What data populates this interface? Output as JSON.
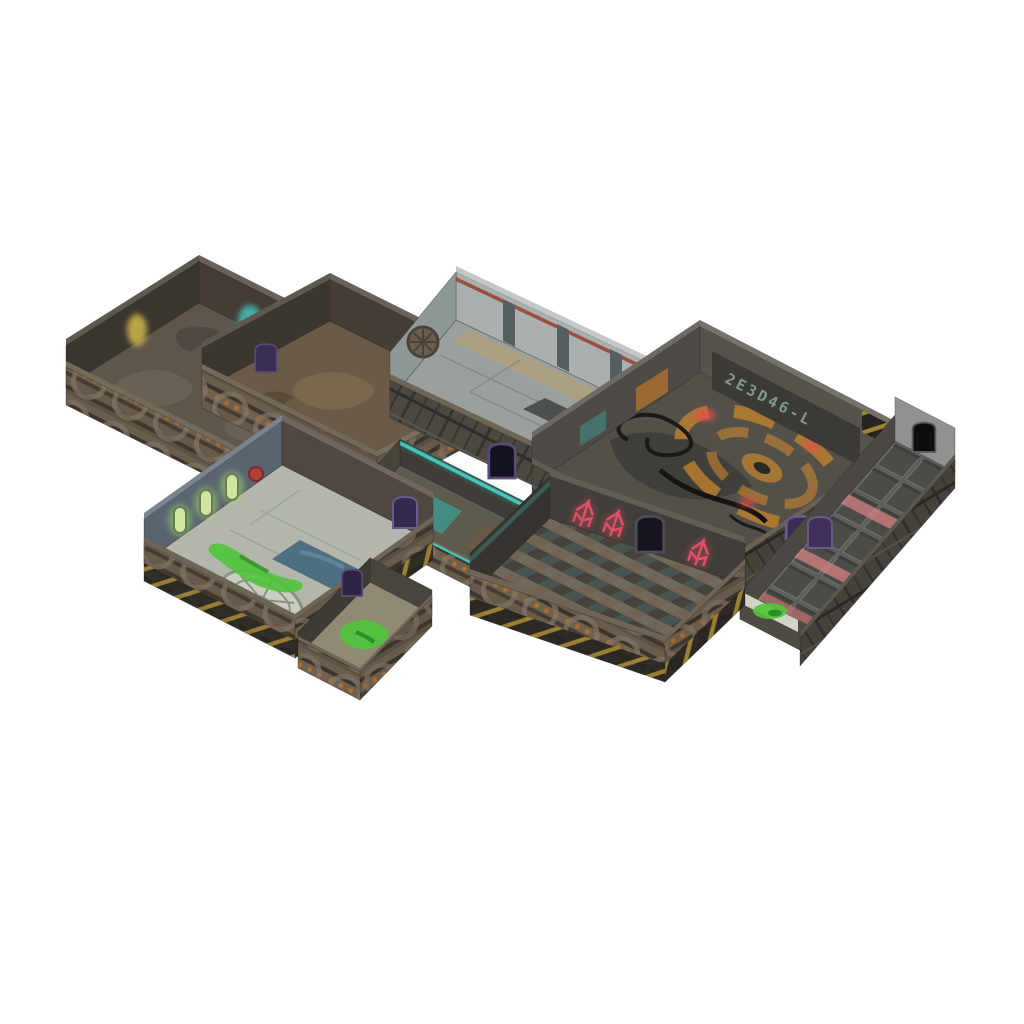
{
  "scene": {
    "type": "product-render",
    "title": "Sci-fi modular dungeon terrain set (isometric render on white background)",
    "description": "Isometric product render of a modular science-fiction tabletop dungeon terrain set: eight interconnected rooms and corridors with riveted pipe walls, yellow-black hazard stripes, glowing purple door frames, slime spills and grimy metal floors.",
    "background": "#ffffff",
    "wall_display_text": "2E3D46-L",
    "modules": [
      {
        "id": "room-a",
        "label": "Barracks room with yellow and teal glow panels"
      },
      {
        "id": "room-b",
        "label": "Storage room with rusted floor and sealed purple doors"
      },
      {
        "id": "room-c",
        "label": "Control room with grey deck plating, hatches and green slime"
      },
      {
        "id": "room-d",
        "label": "Reactor chamber with orange turbine emblem, cables and digital wall display"
      },
      {
        "id": "corridor-e",
        "label": "Walkway with grated deck panels and red hazard lighting"
      },
      {
        "id": "corridor-f",
        "label": "Connecting corridor with teal light strips"
      },
      {
        "id": "room-g",
        "label": "Laboratory with specimen tanks, floor vent fan, pool and chem spill"
      },
      {
        "id": "annex-g",
        "label": "Laboratory annex cell with toxic spill"
      },
      {
        "id": "room-h",
        "label": "Cargo hold with checkered deck and red warning glyphs"
      }
    ]
  },
  "palette": {
    "floor_a": "#5d564c",
    "floor_b": "#6a5a46",
    "floor_c": "#9aa09e",
    "floor_d": "#53504a",
    "floor_f": "#5f5a4e",
    "floor_g": "#b2b6ac",
    "floor_annex": "#8f8a74",
    "wall_inner_dark": "#433c35",
    "wall_inner_grey": "#a9b0ae",
    "wall_blue_grey": "#5a6470",
    "emblem_orange": "#c8862e",
    "slime_green": "#4fc43a",
    "slime_dark": "#2fae4e",
    "glow_teal": "#3fd4c8",
    "glow_yellow": "#d8c050",
    "trident_red": "#e04f66",
    "red_glow": "#e05050",
    "pink_glow": "#e08585",
    "door_purple": "#3a2d52",
    "door_frame": "#6a5a8a",
    "hazard_yellow": "#a08430",
    "red_stripe": "#9a4f44",
    "pool_blue": "#4e6e82",
    "tank_green": "#cfe6a0",
    "display_teal": "#8fa8a0"
  }
}
